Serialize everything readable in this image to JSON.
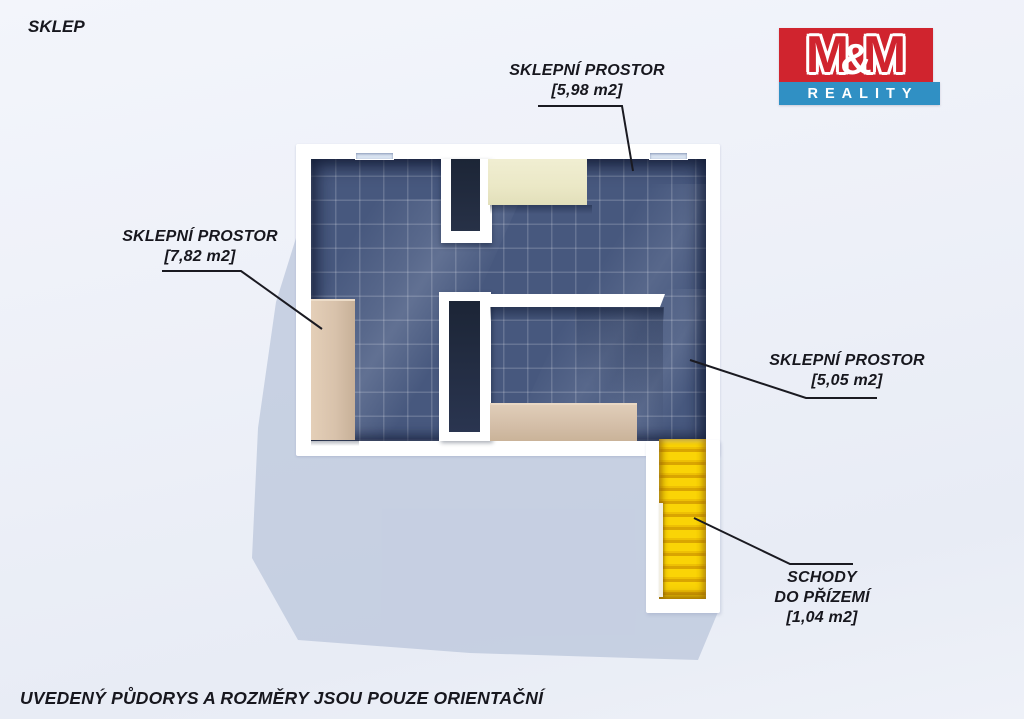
{
  "page": {
    "title": "SKLEP",
    "disclaimer": "UVEDENÝ PŮDORYS A ROZMĚRY JSOU POUZE ORIENTAČNÍ"
  },
  "logo": {
    "m_first": "M",
    "ampersand": "&",
    "m_second": "M",
    "subtitle": "REALITY"
  },
  "labels": {
    "cellar_top": {
      "line1": "SKLEPNÍ PROSTOR",
      "line2": "[5,98 m2]"
    },
    "cellar_left": {
      "line1": "SKLEPNÍ PROSTOR",
      "line2": "[7,82 m2]"
    },
    "cellar_right": {
      "line1": "SKLEPNÍ PROSTOR",
      "line2": "[5,05 m2]"
    },
    "stairs": {
      "line1": "SCHODY",
      "line2": "DO PŘÍZEMÍ",
      "line3": "[1,04 m2]"
    }
  },
  "colors": {
    "logo_red": "#d0242e",
    "logo_blue": "#3090c4",
    "floor_tile": "#47587e",
    "wall_white": "#ffffff",
    "stairs_yellow": "#f6cf04",
    "cabinet_cream": "#ebe8c6",
    "wood_tan": "#d8c2ab",
    "label_text": "#17171e",
    "background": "#edf0f7",
    "shadow": "#b4c0d8"
  }
}
